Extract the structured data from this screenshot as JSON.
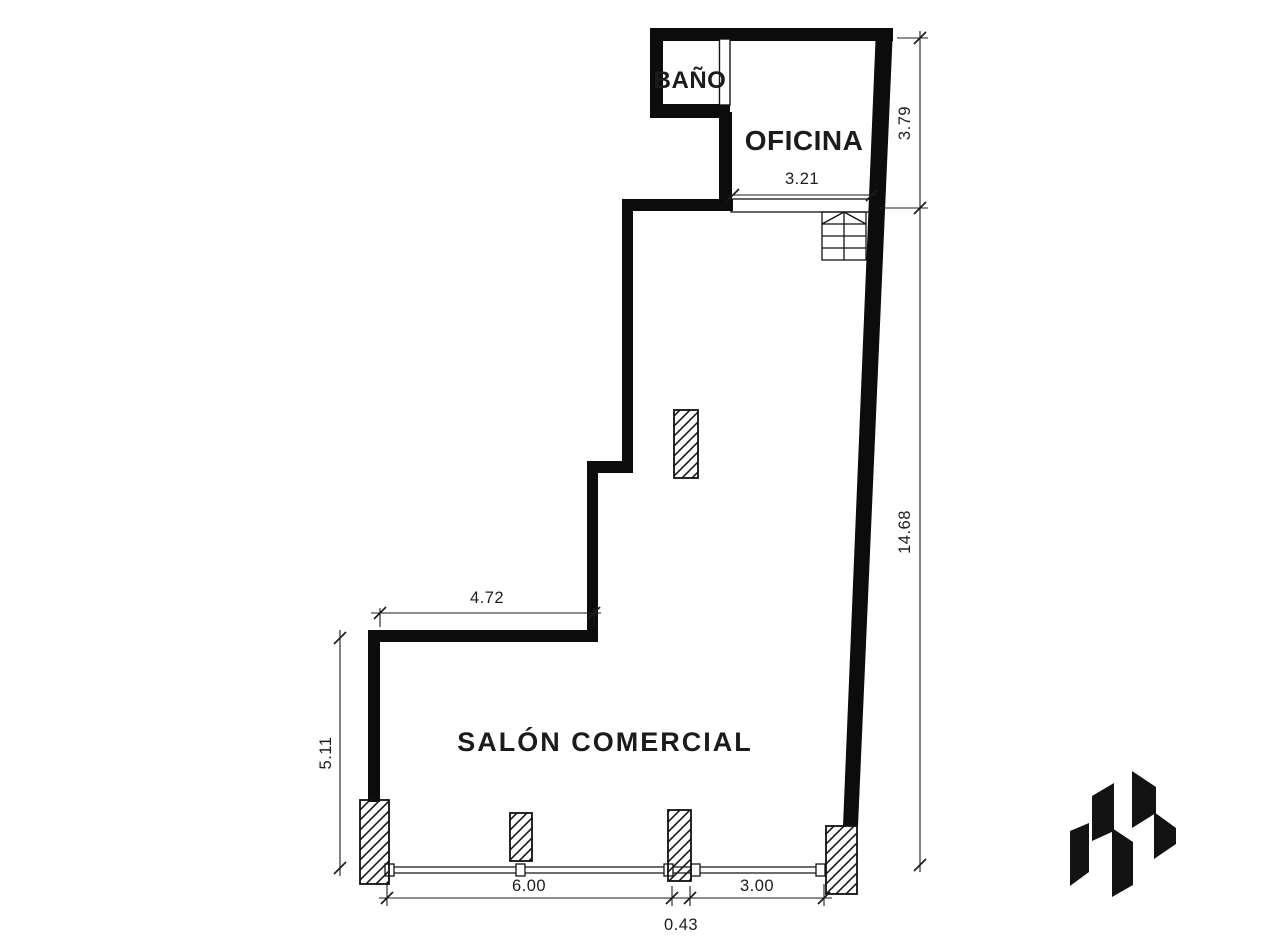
{
  "canvas": {
    "background": "#ffffff",
    "ink": "#0c0c0c",
    "line_color": "#1c1c1c"
  },
  "rooms": {
    "bathroom": "BAÑO",
    "office": "OFICINA",
    "salon": "SALÓN COMERCIAL"
  },
  "dimensions": {
    "office_width": "3.21",
    "office_height": "3.79",
    "right_side": "14.68",
    "upper_ledge": "4.72",
    "left_side": "5.11",
    "storefront_left": "6.00",
    "pillar_width": "0.43",
    "storefront_right": "3.00"
  },
  "icons": {
    "logo": "shard-monogram-logo"
  }
}
